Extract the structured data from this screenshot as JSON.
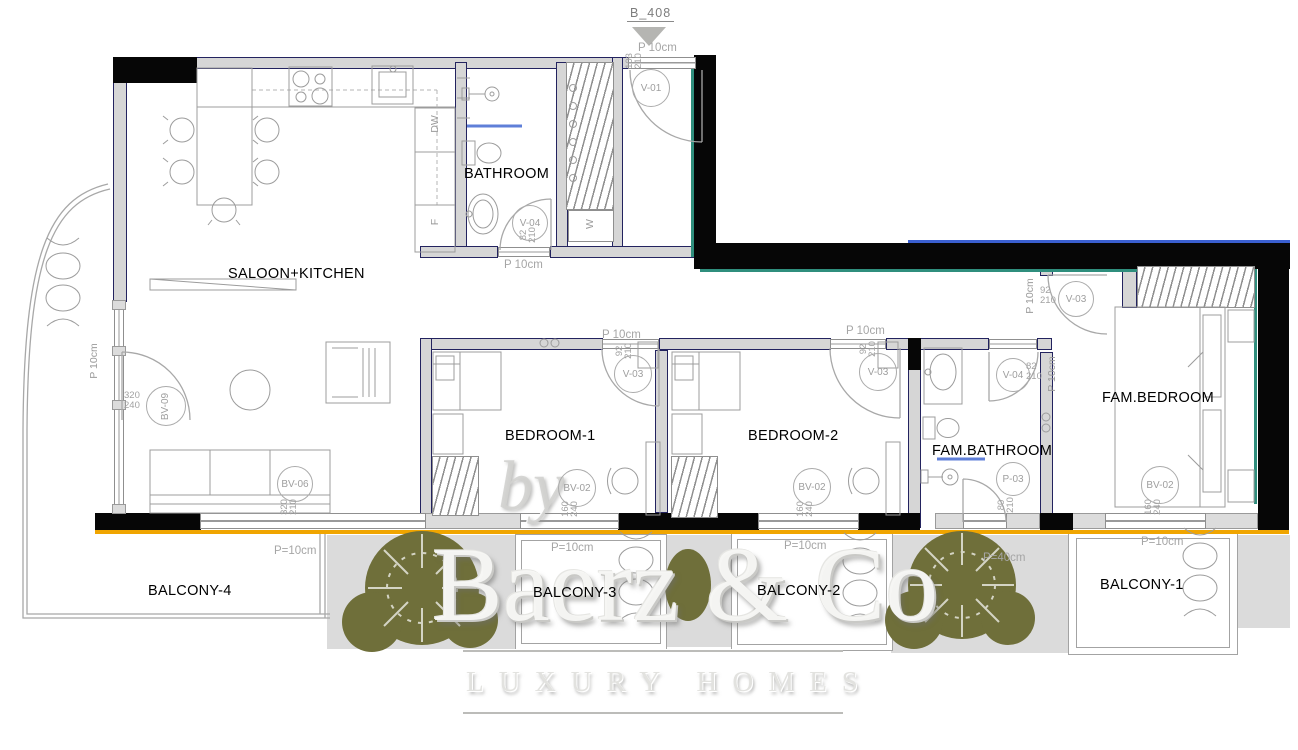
{
  "plan": {
    "unit_label": "B_408",
    "rooms": {
      "saloon": "SALOON+KITCHEN",
      "bathroom": "BATHROOM",
      "bedroom1": "BEDROOM-1",
      "bedroom2": "BEDROOM-2",
      "fam_bathroom": "FAM.BATHROOM",
      "fam_bedroom": "FAM.BEDROOM",
      "balcony1": "BALCONY-1",
      "balcony2": "BALCONY-2",
      "balcony3": "BALCONY-3",
      "balcony4": "BALCONY-4"
    },
    "appliances": {
      "dishwasher": "DW",
      "fridge": "F",
      "washer": "W"
    },
    "openings": {
      "v01": {
        "code": "V-01",
        "w": "103",
        "h": "210"
      },
      "v03": {
        "code": "V-03",
        "w": "92",
        "h": "210"
      },
      "v04": {
        "code": "V-04",
        "w": "82",
        "h": "210"
      },
      "p03": {
        "code": "P-03",
        "w": "80",
        "h": "210"
      },
      "bv02": {
        "code": "BV-02",
        "w": "160",
        "h": "240"
      },
      "bv06": {
        "code": "BV-06",
        "w": "320",
        "h": "210"
      },
      "bv09": {
        "code": "BV-09",
        "w": "320",
        "h": "240"
      }
    },
    "annotations": {
      "p10": "P 10cm",
      "peq10": "P=10cm",
      "peq40": "P=40cm"
    },
    "watermark": {
      "by": "by",
      "brand": "Baerz & Co",
      "tagline": "LUXURY HOMES"
    },
    "colors": {
      "wall_black": "#060606",
      "wall_gray": "#d6d6d6",
      "edge_navy": "#23235f",
      "accent_orange": "#f0a500",
      "accent_teal": "#2f8e7d",
      "accent_blue": "#3a5fd0",
      "tree_olive": "#6f6f3a"
    }
  }
}
